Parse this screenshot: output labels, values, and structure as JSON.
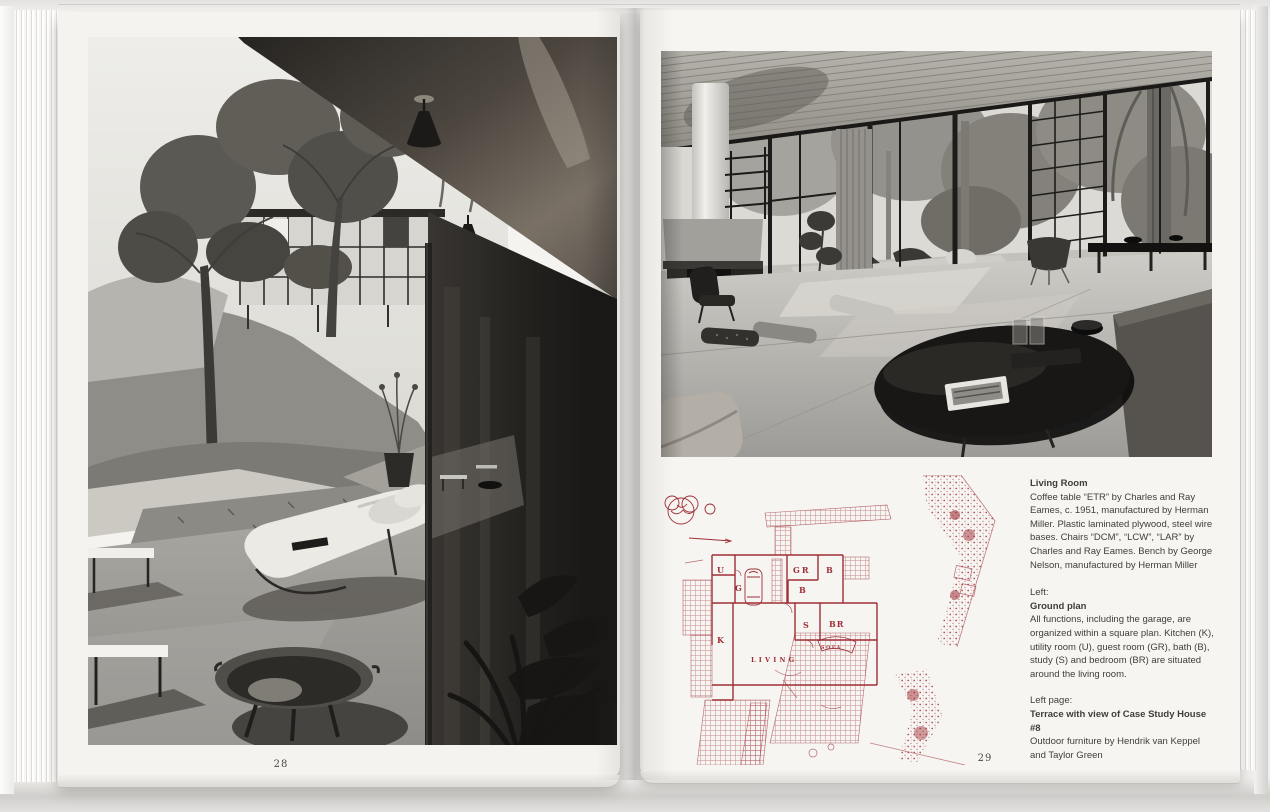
{
  "book": {
    "left_page": {
      "page_number": "28",
      "photo_subject": "Terrace with view of Case Study House #8"
    },
    "right_page": {
      "page_number": "29",
      "photo_subject": "Living Room",
      "captions": {
        "living_room": {
          "heading": "Living Room",
          "body": "Coffee table “ETR” by Charles and Ray Eames, c. 1951, manufactured by Herman Miller. Plastic laminated plywood, steel wire bases. Chairs “DCM”, “LCW”, “LAR” by Charles and Ray Eames. Bench by George Nelson, manufactured by Herman Miller"
        },
        "ground_plan": {
          "kicker": "Left:",
          "heading": "Ground plan",
          "body": "All functions, including the garage, are organized within a square plan. Kitchen (K), utility room (U), guest room (GR), bath (B), study (S) and bedroom (BR) are situated around the living room."
        },
        "left_page_ref": {
          "kicker": "Left page:",
          "heading": "Terrace with view of Case Study House #8",
          "body": "Outdoor furniture by Hendrik van Keppel and Taylor Green"
        }
      },
      "plan": {
        "labels": {
          "u": "U",
          "g": "G",
          "gr": "GR",
          "b1": "B",
          "b2": "B",
          "k": "K",
          "s": "S",
          "br": "BR",
          "living": "LIVING",
          "sofa": "SOFA"
        }
      }
    }
  },
  "colors": {
    "plan_red": "#9e2f36",
    "page_white": "#f4f3ef",
    "caption_text": "#3f3e3b"
  }
}
